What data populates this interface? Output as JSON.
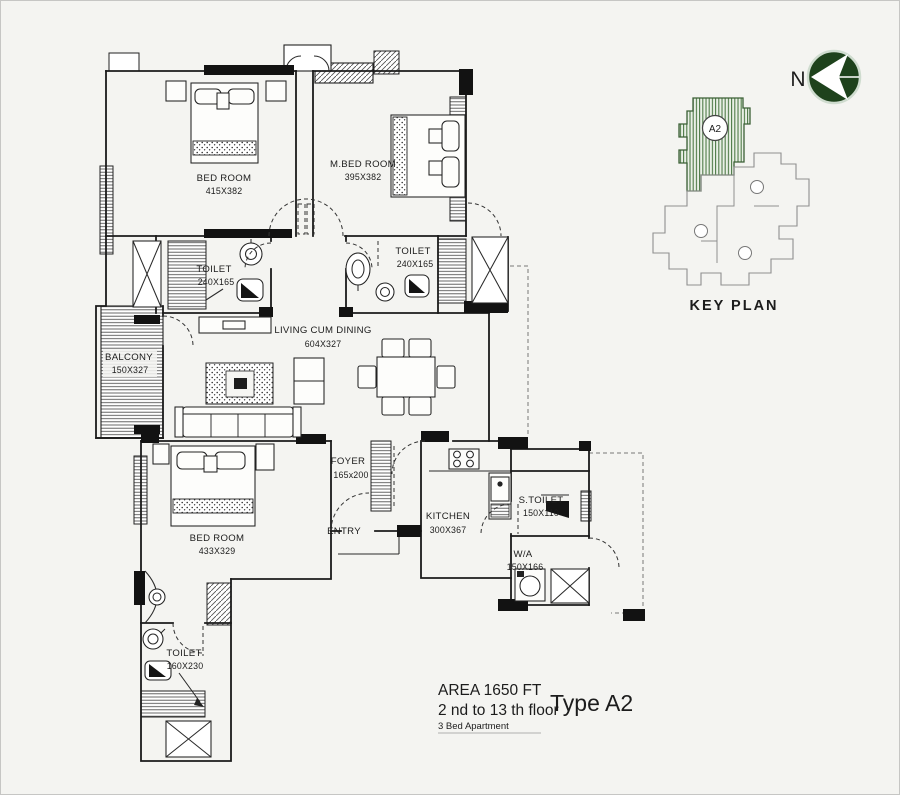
{
  "plan": {
    "rooms": {
      "bed1": {
        "name": "BED ROOM",
        "dims": "415X382"
      },
      "mbed": {
        "name": "M.BED ROOM",
        "dims": "395X382"
      },
      "toilet1": {
        "name": "TOILET",
        "dims": "240X165"
      },
      "toilet2": {
        "name": "TOILET",
        "dims": "240X165"
      },
      "balcony": {
        "name": "BALCONY",
        "dims": "150X327"
      },
      "living": {
        "name": "LIVING CUM DINING",
        "dims": "604X327"
      },
      "foyer": {
        "name": "FOYER",
        "dims": "165x200"
      },
      "entry_label": "ENTRY",
      "kitchen": {
        "name": "KITCHEN",
        "dims": "300X367"
      },
      "stoilet": {
        "name": "S.TOILET",
        "dims": "150X110"
      },
      "wa": {
        "name": "W/A",
        "dims": "150X166"
      },
      "bed3": {
        "name": "BED ROOM",
        "dims": "433X329"
      },
      "toilet3": {
        "name": "TOILET",
        "dims": "160X230"
      }
    }
  },
  "key_plan": {
    "title": "KEY PLAN",
    "unit": "A2",
    "north": "N"
  },
  "info": {
    "area": "AREA 1650 FT",
    "floors": "2 nd to 13 th floor",
    "subtitle": "3 Bed Apartment",
    "type": "Type A2"
  },
  "colors": {
    "wall": "#1b1b1b",
    "background": "#f4f4f1",
    "keyplan_green": "#1e421c",
    "keyplan_unit_stripe": "#4d7a46",
    "keyplan_outline": "#8f8f8f"
  }
}
